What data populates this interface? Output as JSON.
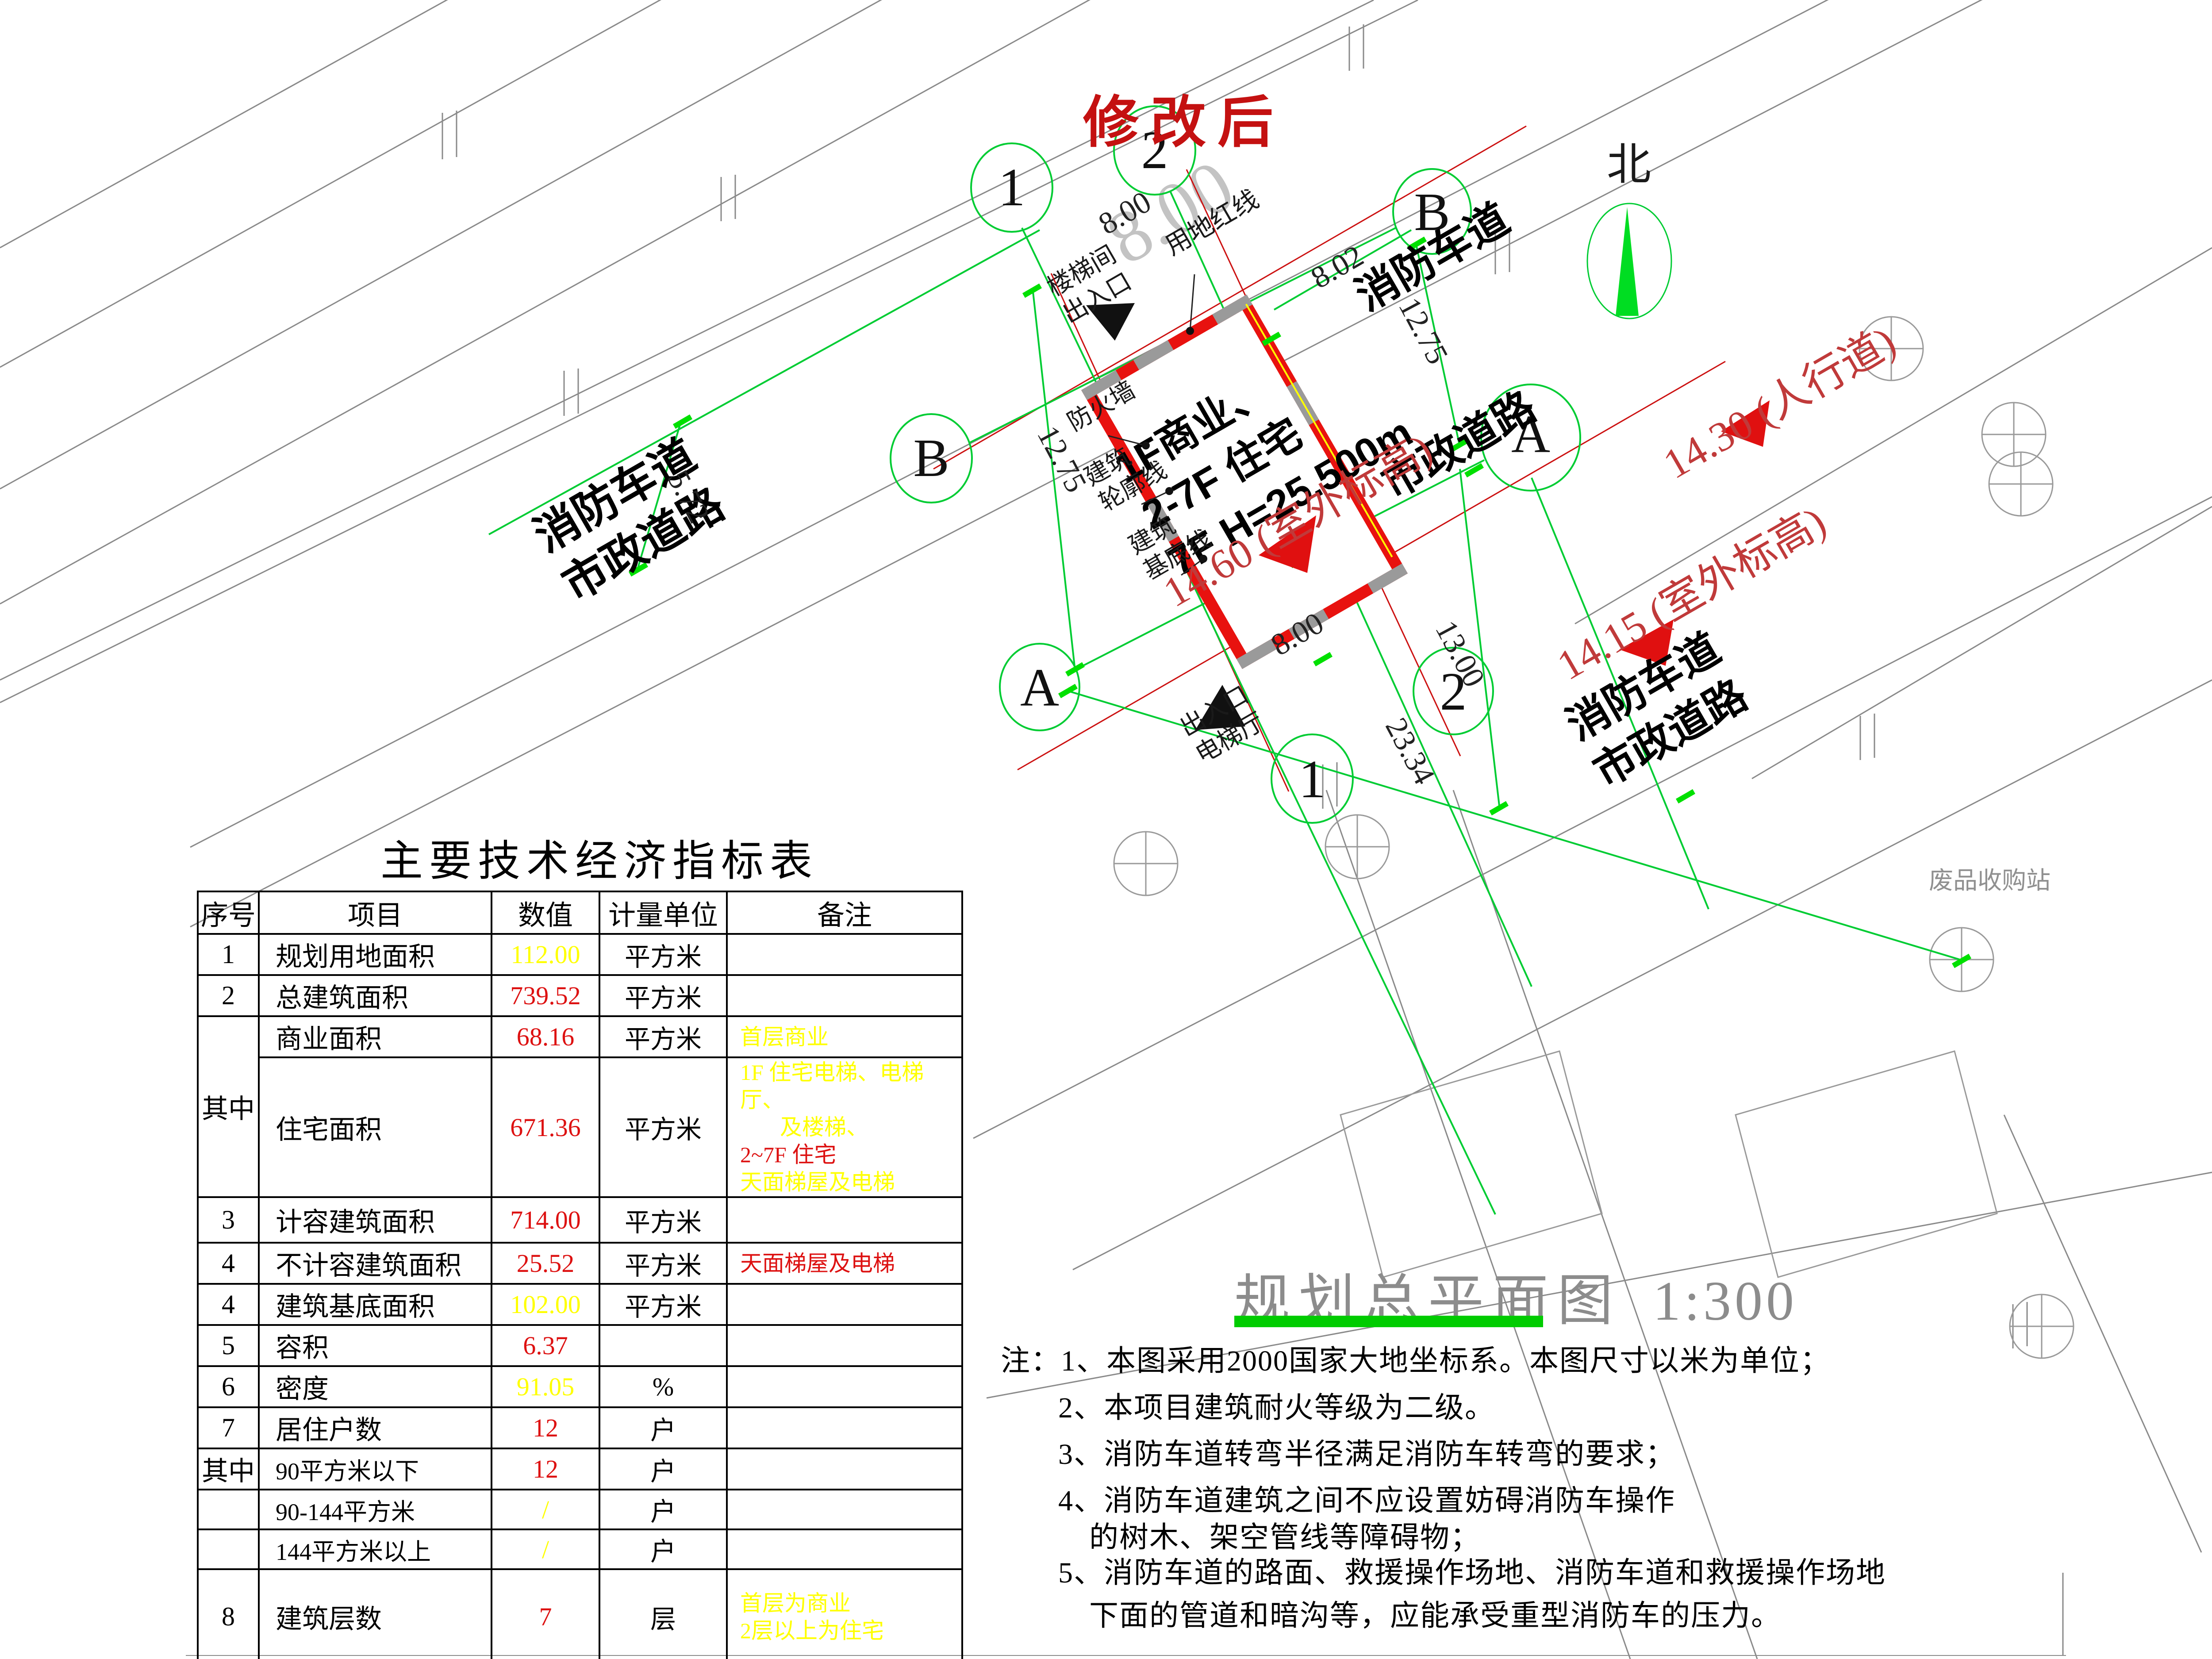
{
  "colors": {
    "building_red": "#e8120f",
    "grid_green": "#00cc33",
    "tick_green": "#00e000",
    "value_red": "#dd1111",
    "value_yellow": "#ffff00",
    "road_gray": "#8a8a8a"
  },
  "stamp": {
    "text": "修改后"
  },
  "north": {
    "label": "北"
  },
  "building": {
    "line1": "1F商业、",
    "line2": "2-7F 住宅",
    "line3": "7F H=25.500m"
  },
  "roads": {
    "left_fire_lane": "消防车道",
    "left_municipal": "市政道路",
    "top_fire_lane": "消防车道",
    "right_municipal": "市政道路",
    "br_fire_lane": "消防车道",
    "br_municipal": "市政道路",
    "sidewalk": "14.30 (人行道)"
  },
  "elevations": {
    "e1": "14.60 (室外标高)",
    "e2": "14.15 (室外标高)"
  },
  "site_labels": {
    "stair": "楼梯间",
    "stair2": "出入口",
    "entrance": "出入口",
    "lobby": "电梯厅",
    "firewall": "防火墙",
    "outline1": "建筑",
    "outline2": "轮廓线",
    "base1": "建筑",
    "base2": "基底线",
    "redline": "用地红线",
    "scrap": "废品收购站"
  },
  "dims": {
    "top8": "8.00",
    "d802": "8.02",
    "r1275": "12.75",
    "l1275": "12.75",
    "d572": "5.72",
    "b8": "8.00",
    "d13": "13.00",
    "d2334": "23.34",
    "ghost8": "8.00"
  },
  "grid": {
    "b1": "1",
    "b2": "2",
    "b3": "B",
    "b4": "B",
    "b5": "A",
    "b6": "A",
    "b7": "2",
    "b8": "1"
  },
  "plan_title": {
    "name": "规划总平面图",
    "scale": "1:300"
  },
  "notes": {
    "l1": "注：1、本图采用2000国家大地坐标系。本图尺寸以米为单位；",
    "l2": "2、本项目建筑耐火等级为二级。",
    "l3": "3、消防车道转弯半径满足消防车转弯的要求；",
    "l4": "4、消防车道建筑之间不应设置妨碍消防车操作",
    "l5": "的树木、架空管线等障碍物；",
    "l6": "5、消防车道的路面、救援操作场地、消防车道和救援操作场地",
    "l7": "下面的管道和暗沟等，应能承受重型消防车的压力。"
  },
  "table": {
    "title": "主要技术经济指标表",
    "headers": [
      "序号",
      "项目",
      "数值",
      "计量单位",
      "备注"
    ],
    "rows": [
      {
        "no": "1",
        "item": "规划用地面积",
        "value": "112.00",
        "value_color": "#ffff00",
        "unit": "平方米",
        "remark": []
      },
      {
        "no": "2",
        "item": "总建筑面积",
        "value": "739.52",
        "value_color": "#dd1111",
        "unit": "平方米",
        "remark": []
      },
      {
        "no": "其中",
        "item": "商业面积",
        "value": "68.16",
        "value_color": "#dd1111",
        "unit": "平方米",
        "remark": [
          {
            "text": "首层商业",
            "color": "#ffff00"
          }
        ]
      },
      {
        "no": "",
        "item": "住宅面积",
        "value": "671.36",
        "value_color": "#dd1111",
        "unit": "平方米",
        "remark": [
          {
            "text": "1F 住宅电梯、电梯厅、",
            "color": "#ffff00"
          },
          {
            "text": "及楼梯、",
            "color": "#ffff00"
          },
          {
            "text": "2~7F 住宅",
            "color": "#dd1111"
          },
          {
            "text": "天面梯屋及电梯",
            "color": "#ffff00"
          }
        ]
      },
      {
        "no": "3",
        "item": "计容建筑面积",
        "value": "714.00",
        "value_color": "#dd1111",
        "unit": "平方米",
        "remark": []
      },
      {
        "no": "4",
        "item": "不计容建筑面积",
        "value": "25.52",
        "value_color": "#dd1111",
        "unit": "平方米",
        "remark": [
          {
            "text": "天面梯屋及电梯",
            "color": "#dd1111"
          }
        ]
      },
      {
        "no": "4",
        "item": "建筑基底面积",
        "value": "102.00",
        "value_color": "#ffff00",
        "unit": "平方米",
        "remark": []
      },
      {
        "no": "5",
        "item": "容积",
        "value": "6.37",
        "value_color": "#dd1111",
        "unit": "",
        "remark": []
      },
      {
        "no": "6",
        "item": "密度",
        "value": "91.05",
        "value_color": "#ffff00",
        "unit": "%",
        "remark": []
      },
      {
        "no": "7",
        "item": "居住户数",
        "value": "12",
        "value_color": "#dd1111",
        "unit": "户",
        "remark": []
      },
      {
        "no": "其中",
        "item": "90平方米以下",
        "value": "12",
        "value_color": "#dd1111",
        "unit": "户",
        "remark": []
      },
      {
        "no": "",
        "item": "90-144平方米",
        "value": "/",
        "value_color": "#ffff00",
        "unit": "户",
        "remark": []
      },
      {
        "no": "",
        "item": "144平方米以上",
        "value": "/",
        "value_color": "#ffff00",
        "unit": "户",
        "remark": []
      },
      {
        "no": "8",
        "item": "建筑层数",
        "value": "7",
        "value_color": "#dd1111",
        "unit": "层",
        "remark": [
          {
            "text": "首层为商业",
            "color": "#ffff00"
          },
          {
            "text": "2层以上为住宅",
            "color": "#ffff00"
          }
        ]
      },
      {
        "no": "9",
        "item": "建筑规划高度",
        "value": "25.500",
        "value_color": "#dd1111",
        "unit": "米",
        "remark": [
          {
            "text": "室外地面至女儿墙",
            "color": "#ffff00"
          }
        ]
      }
    ]
  }
}
